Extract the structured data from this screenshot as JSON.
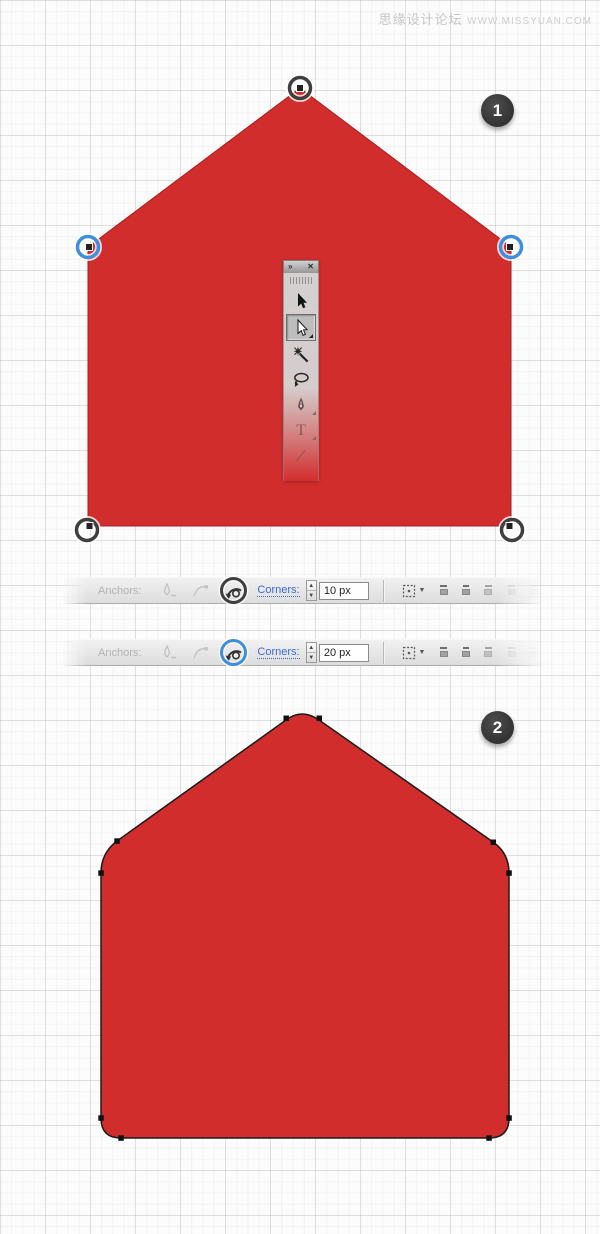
{
  "watermark": {
    "site_name": "思缘设计论坛",
    "site_url": "WWW.MISSYUAN.COM"
  },
  "badges": [
    {
      "label": "1"
    },
    {
      "label": "2"
    }
  ],
  "toolbar": {
    "collapse_icon": "»",
    "close_icon": "✕",
    "type_tool_glyph": "T",
    "tools": [
      "selection-tool",
      "direct-selection-tool",
      "magic-wand-tool",
      "lasso-tool",
      "pen-tool",
      "type-tool",
      "line-segment-tool"
    ],
    "selected_tool": "direct-selection-tool"
  },
  "control_bars": [
    {
      "anchors_label": "Anchors:",
      "corners_label": "Corners:",
      "corner_radius_value": "10 px",
      "annotation_color": "#3f3f3f"
    },
    {
      "anchors_label": "Anchors:",
      "corners_label": "Corners:",
      "corner_radius_value": "20 px",
      "annotation_color": "#3f8fdf"
    }
  ],
  "colors": {
    "shape_fill": "#d22d2d",
    "shape1_stroke": "#a91f1f",
    "shape2_stroke": "#1c1c1c",
    "selection_blue": "#3f8fdf",
    "annotation_dark": "#3f3f3f",
    "anchor_point": "#222222",
    "link_blue": "#3a6bd0",
    "badge_bg": "#3a3a3a"
  }
}
